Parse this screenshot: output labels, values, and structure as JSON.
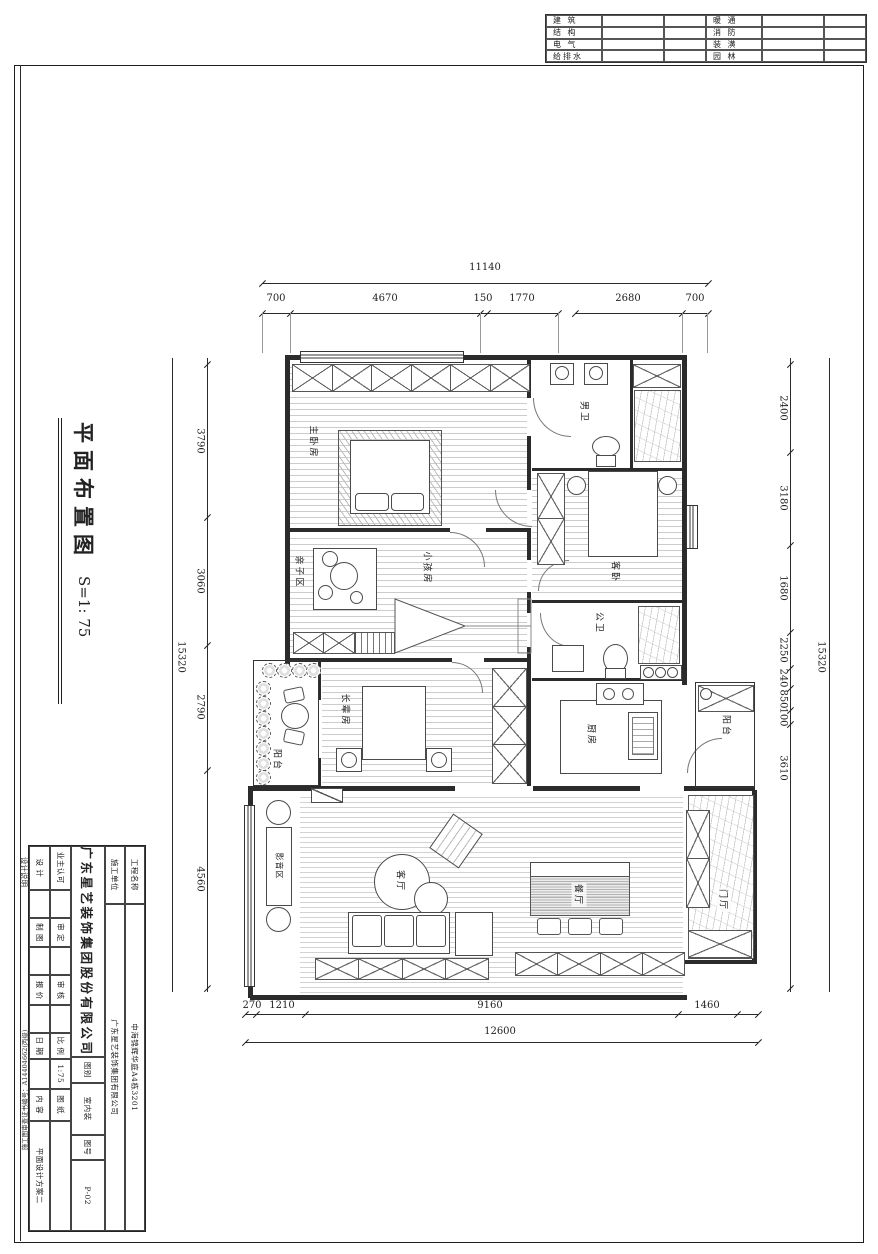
{
  "header_table": {
    "rows": [
      {
        "l": "建  筑",
        "r": "暖  通"
      },
      {
        "l": "结  构",
        "r": "消  防"
      },
      {
        "l": "电  气",
        "r": "装  潢"
      },
      {
        "l": "给排水",
        "r": "园  林"
      }
    ]
  },
  "side_title": {
    "title": "平面布置图",
    "scale": "S=1: 75"
  },
  "dimensions": {
    "top_total": "11140",
    "top_segments": [
      "700",
      "4670",
      "150",
      "1770",
      "2680",
      "700"
    ],
    "left_total": "15320",
    "left_segments": [
      "3790",
      "3060",
      "2790",
      "4560"
    ],
    "right_total": "15320",
    "right_segments": [
      "2400",
      "3180",
      "1680",
      "2250",
      "240",
      "850",
      "100",
      "3610"
    ],
    "bottom_segments": [
      "270",
      "1210",
      "9160",
      "1460"
    ],
    "bottom_total": "12600"
  },
  "rooms": {
    "master": "主卧房",
    "men_bath": "男卫",
    "guest": "客卧",
    "kids": "小孩房",
    "family": "亲子区",
    "public_bath": "公卫",
    "elder": "长辈房",
    "balcony_left": "阳台",
    "balcony_right": "阳台",
    "kitchen": "厨房",
    "living": "客厅",
    "dining": "餐厅",
    "foyer": "门厅",
    "media": "影音区"
  },
  "title_block": {
    "project_label": "工程名称",
    "project": "中海锦辉华庭A4栋3201",
    "builder_label": "施工单位",
    "builder": "广东星艺装饰集团有限公司",
    "company": "广东星艺装饰集团股份有限公司",
    "category_label": "图别",
    "category": "室内装",
    "sheet_no_label": "图号",
    "sheet_no": "P-02",
    "owner_label": "业主认可",
    "approved_label": "审 定",
    "checked_label": "审 核",
    "scale_label": "比 例",
    "scale": "1:75",
    "drawing_label": "图 纸",
    "content_label": "内 容",
    "content": "平面设计方案二",
    "design_label": "设 计",
    "draft_label": "制 图",
    "quote_label": "报 价",
    "date_label": "日 期",
    "note": "设计说明",
    "cert": "施工图审查证书编号：A14404662(丙级)"
  }
}
